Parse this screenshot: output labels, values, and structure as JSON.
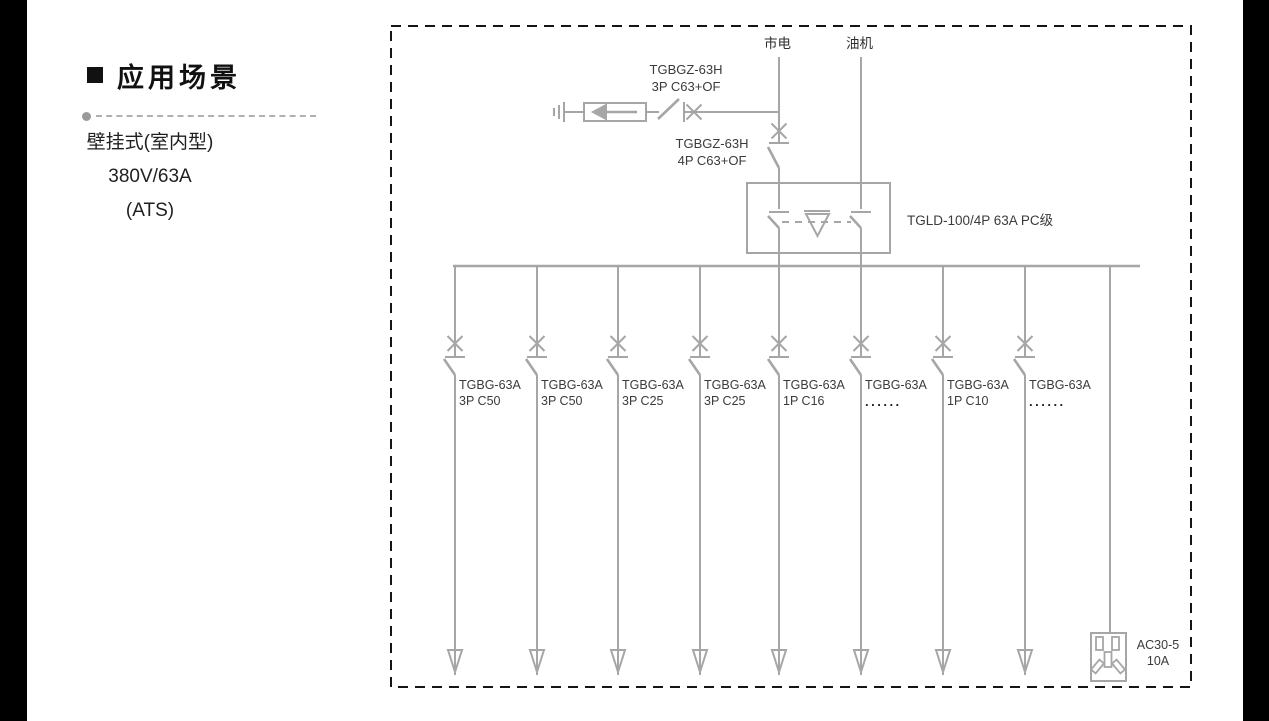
{
  "sidebar": {
    "title": "应用场景",
    "items": [
      "壁挂式(室内型)",
      "380V/63A",
      "(ATS)"
    ]
  },
  "diagram": {
    "sources": {
      "mains": "市电",
      "generator": "油机"
    },
    "spd_breaker": {
      "line1": "TGBGZ-63H",
      "line2": "3P C63+OF"
    },
    "main_breaker": {
      "line1": "TGBGZ-63H",
      "line2": "4P C63+OF"
    },
    "ats": {
      "label": "TGLD-100/4P 63A PC级"
    },
    "branches": [
      {
        "model": "TGBG-63A",
        "spec": "3P C50"
      },
      {
        "model": "TGBG-63A",
        "spec": "3P C50"
      },
      {
        "model": "TGBG-63A",
        "spec": "3P C25"
      },
      {
        "model": "TGBG-63A",
        "spec": "3P C25"
      },
      {
        "model": "TGBG-63A",
        "spec": "1P C16"
      },
      {
        "model": "TGBG-63A",
        "spec": "......"
      },
      {
        "model": "TGBG-63A",
        "spec": "1P C10"
      },
      {
        "model": "TGBG-63A",
        "spec": "......"
      }
    ],
    "socket": {
      "line1": "AC30-5",
      "line2": "10A"
    },
    "colors": {
      "line": "#a6a6a6",
      "text": "#3b3b3b",
      "border": "#151515"
    }
  }
}
